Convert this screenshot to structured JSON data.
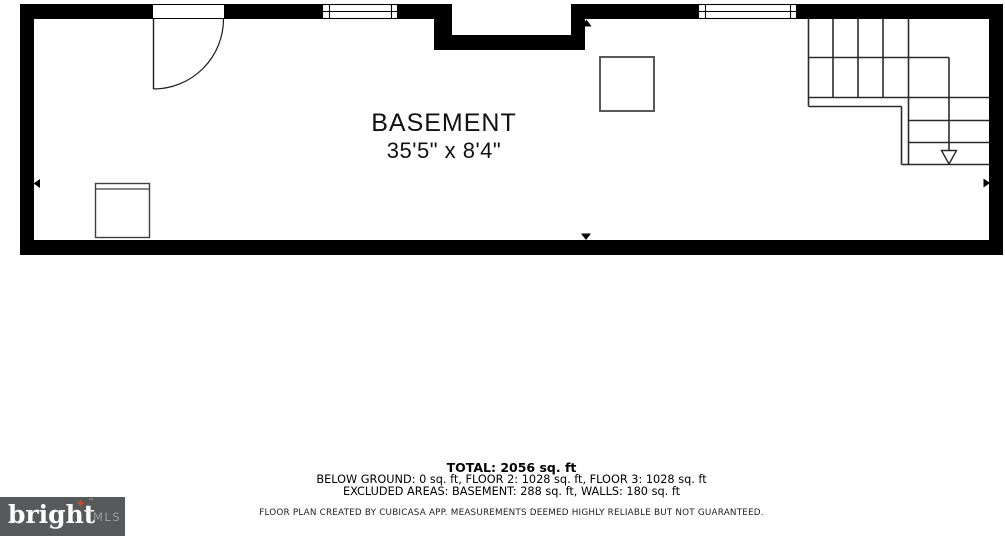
{
  "plan": {
    "room": {
      "label": "BASEMENT",
      "dimensions": "35'5\" x 8'4\""
    }
  },
  "summary": {
    "total": "TOTAL: 2056 sq. ft",
    "floors": "BELOW GROUND: 0 sq. ft, FLOOR 2: 1028 sq. ft, FLOOR 3: 1028 sq. ft",
    "excluded": "EXCLUDED AREAS: BASEMENT: 288 sq. ft, WALLS: 180 sq. ft"
  },
  "disclaimer": "FLOOR PLAN CREATED BY CUBICASA APP. MEASUREMENTS DEEMED HIGHLY RELIABLE BUT NOT GUARANTEED.",
  "logo": {
    "brand": "bright",
    "star_icon": "✦",
    "trademark": "™",
    "suffix": "MLS"
  },
  "colors": {
    "wall": "#000000",
    "stair_line": "#2a2a2a",
    "fixture_border": "#58585a",
    "logo_bg": "#58595b",
    "logo_brand": "#ffffff",
    "logo_suffix": "#9d9d9c",
    "logo_star": "#bf4b31"
  }
}
